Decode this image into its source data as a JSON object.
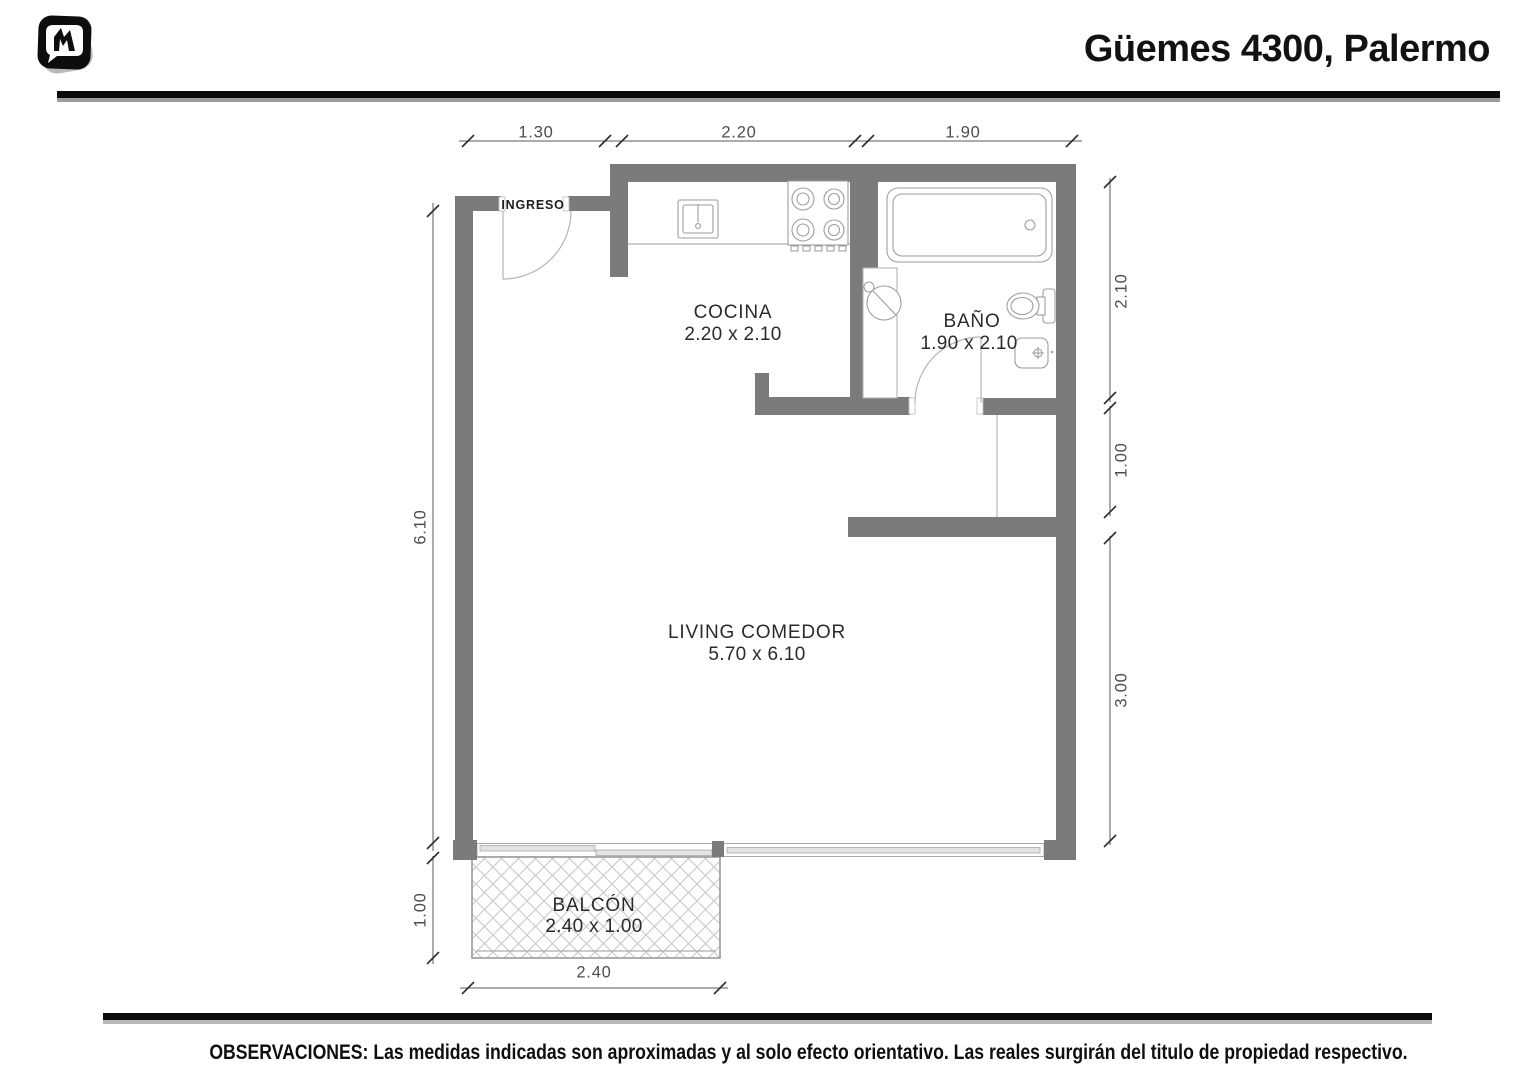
{
  "header": {
    "title": "Güemes 4300, Palermo",
    "logo": "mudafy-m-logo"
  },
  "rooms": {
    "ingreso": {
      "name": "INGRESO"
    },
    "cocina": {
      "name": "COCINA",
      "size": "2.20 x 2.10"
    },
    "bano": {
      "name": "BAÑO",
      "size": "1.90 x 2.10"
    },
    "living": {
      "name": "LIVING COMEDOR",
      "size": "5.70 x 6.10"
    },
    "balcon": {
      "name": "BALCÓN",
      "size": "2.40 x 1.00"
    }
  },
  "dimensions": {
    "top_1": "1.30",
    "top_2": "2.20",
    "top_3": "1.90",
    "left_1": "6.10",
    "left_2": "1.00",
    "right_1": "2.10",
    "right_2": "1.00",
    "right_3": "3.00",
    "bottom_1": "2.40"
  },
  "footer": {
    "observations": "OBSERVACIONES: Las medidas indicadas son aproximadas y al solo efecto orientativo. Las reales surgirán del titulo de propiedad respectivo."
  },
  "colors": {
    "wall": "#7b7b7b",
    "fixture_line": "#9e9e9e",
    "hatch_line": "#c6c6c6",
    "dimension_text": "#4d4d4d",
    "bar_black": "#0c0c0c"
  }
}
